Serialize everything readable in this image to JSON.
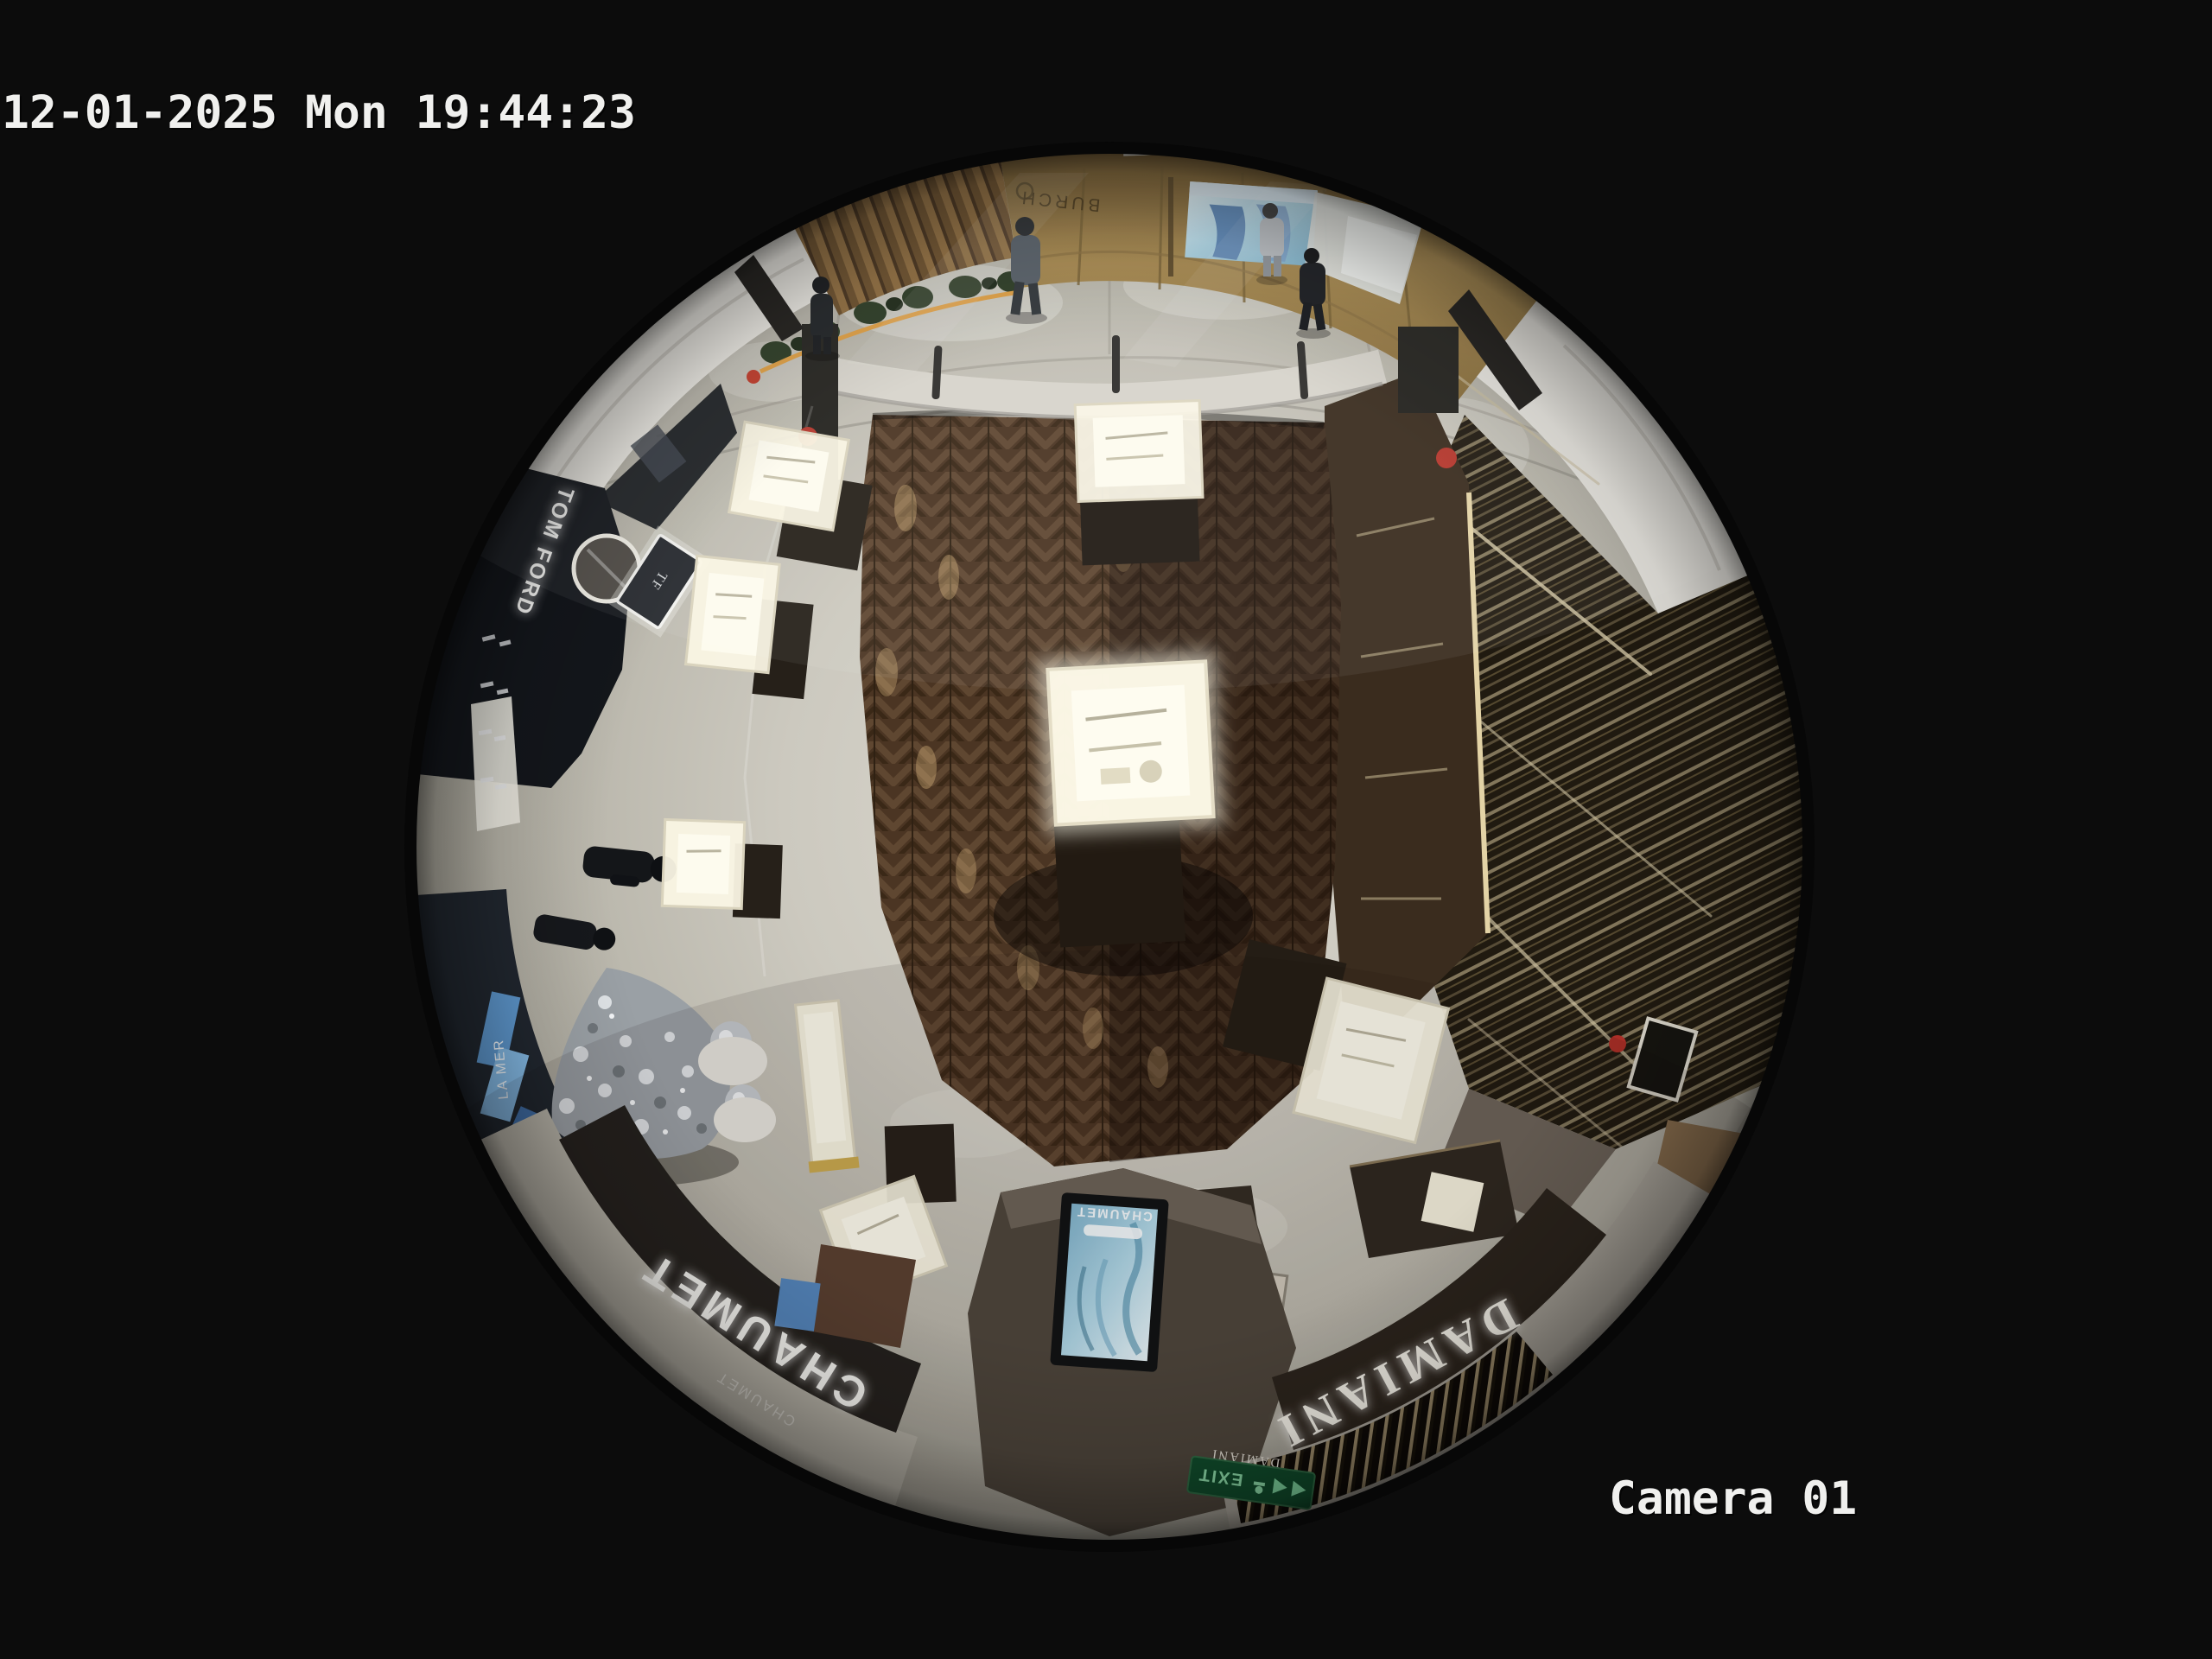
{
  "overlay": {
    "timestamp": "12-01-2025 Mon 19:44:23",
    "camera_label": "Camera 01"
  },
  "scene": {
    "stores": {
      "tom_ford": "TOM FORD",
      "tom_ford_monogram": "TF",
      "chaumet_sign": "CHAUMET",
      "chaumet_sign_small": "CHAUMET",
      "chaumet_screen_brand": "CHAUMET",
      "damiani_sign": "DAMIANI",
      "damiani_sign_small": "DAMIANI",
      "tory_burch_wall": "BURCH",
      "la_mer": "LA MER",
      "exit_sign": "EXIT"
    },
    "colors": {
      "background": "#0c0c0c",
      "osd_text": "#f0f0ee",
      "wood_floor": "#4b3523",
      "marble_floor": "#c9c6bc",
      "gold_wall": "#a8894e",
      "signage_band": "#24211d",
      "exit_green": "#0f4d2c",
      "screen_blue": "#8fb6d6",
      "tree_silver": "#c9cdd1"
    }
  }
}
